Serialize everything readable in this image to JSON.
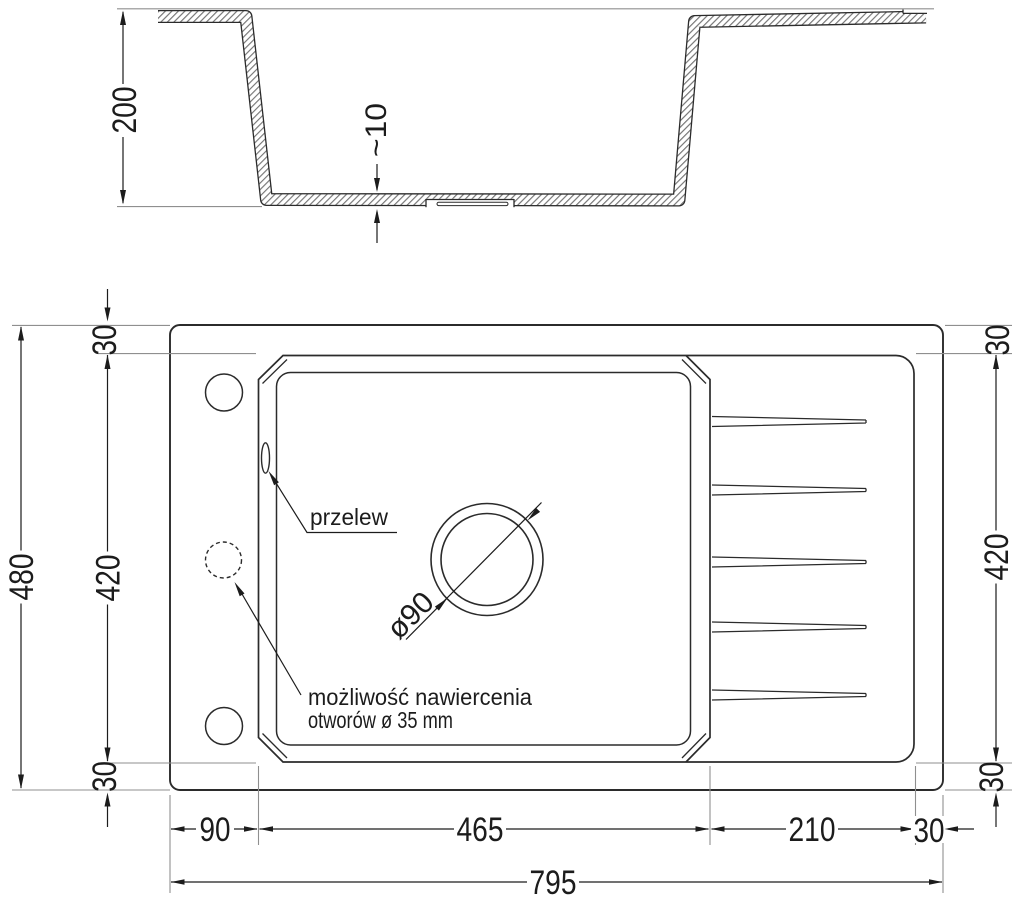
{
  "drawing_title": "sink-technical-drawing",
  "colors": {
    "line": "#2b2b2b",
    "dimension": "#1c1c1c",
    "extension": "#8f8f8f",
    "hatch": "#757575",
    "background": "#ffffff"
  },
  "cross_section": {
    "depth_label": "200",
    "bottom_thickness_label": "~10"
  },
  "plan_view": {
    "overflow_label": "przelew",
    "drain_diameter_label": "ø90",
    "drill_note_line1": "możliwość nawiercenia",
    "drill_note_line2": "otworów ø 35 mm"
  },
  "dimensions": {
    "overall_width": "795",
    "overall_depth": "480",
    "left_rim_width": "90",
    "bowl_width": "465",
    "drainer_width": "210",
    "right_rim_width": "30",
    "top_rim_left": "30",
    "inner_depth_left": "420",
    "bottom_rim_left": "30",
    "top_rim_right": "30",
    "inner_depth_right": "420",
    "bottom_rim_right": "30"
  }
}
